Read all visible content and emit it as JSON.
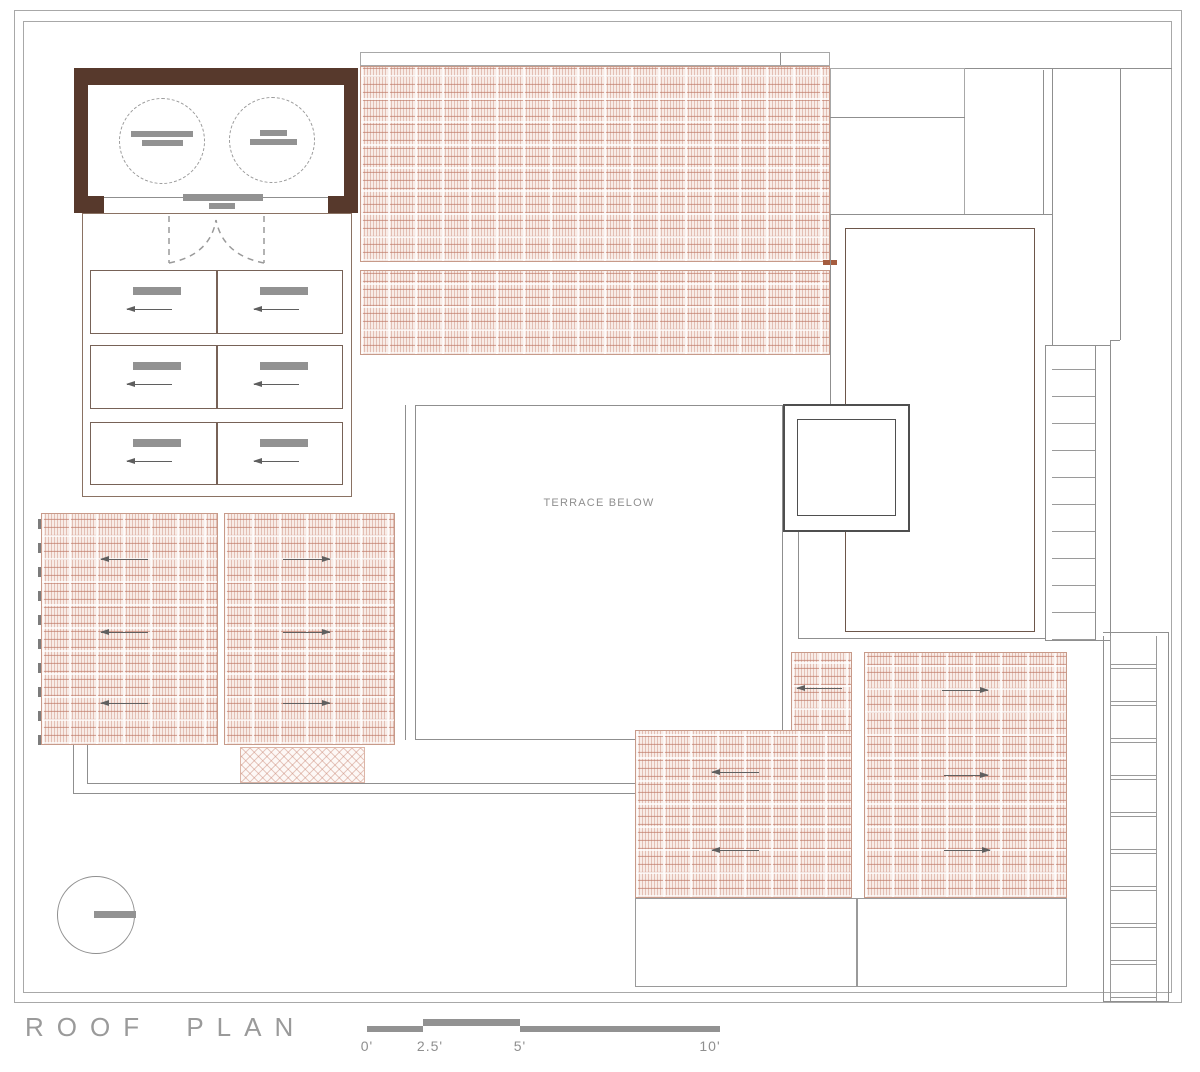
{
  "title": "ROOF PLAN",
  "terrace": {
    "label": "TERRACE BELOW"
  },
  "scale_bar": {
    "labels": [
      "0'",
      "2.5'",
      "5'",
      "10'"
    ]
  },
  "colors": {
    "wall_brown": "#57392c",
    "line_gray": "#8f8f8f",
    "line_brown": "#8a7263",
    "fill_bar_gray": "#929292",
    "hatch_salmon": "#cf9484",
    "tick_orange": "#a55c3f",
    "background": "#ffffff"
  }
}
